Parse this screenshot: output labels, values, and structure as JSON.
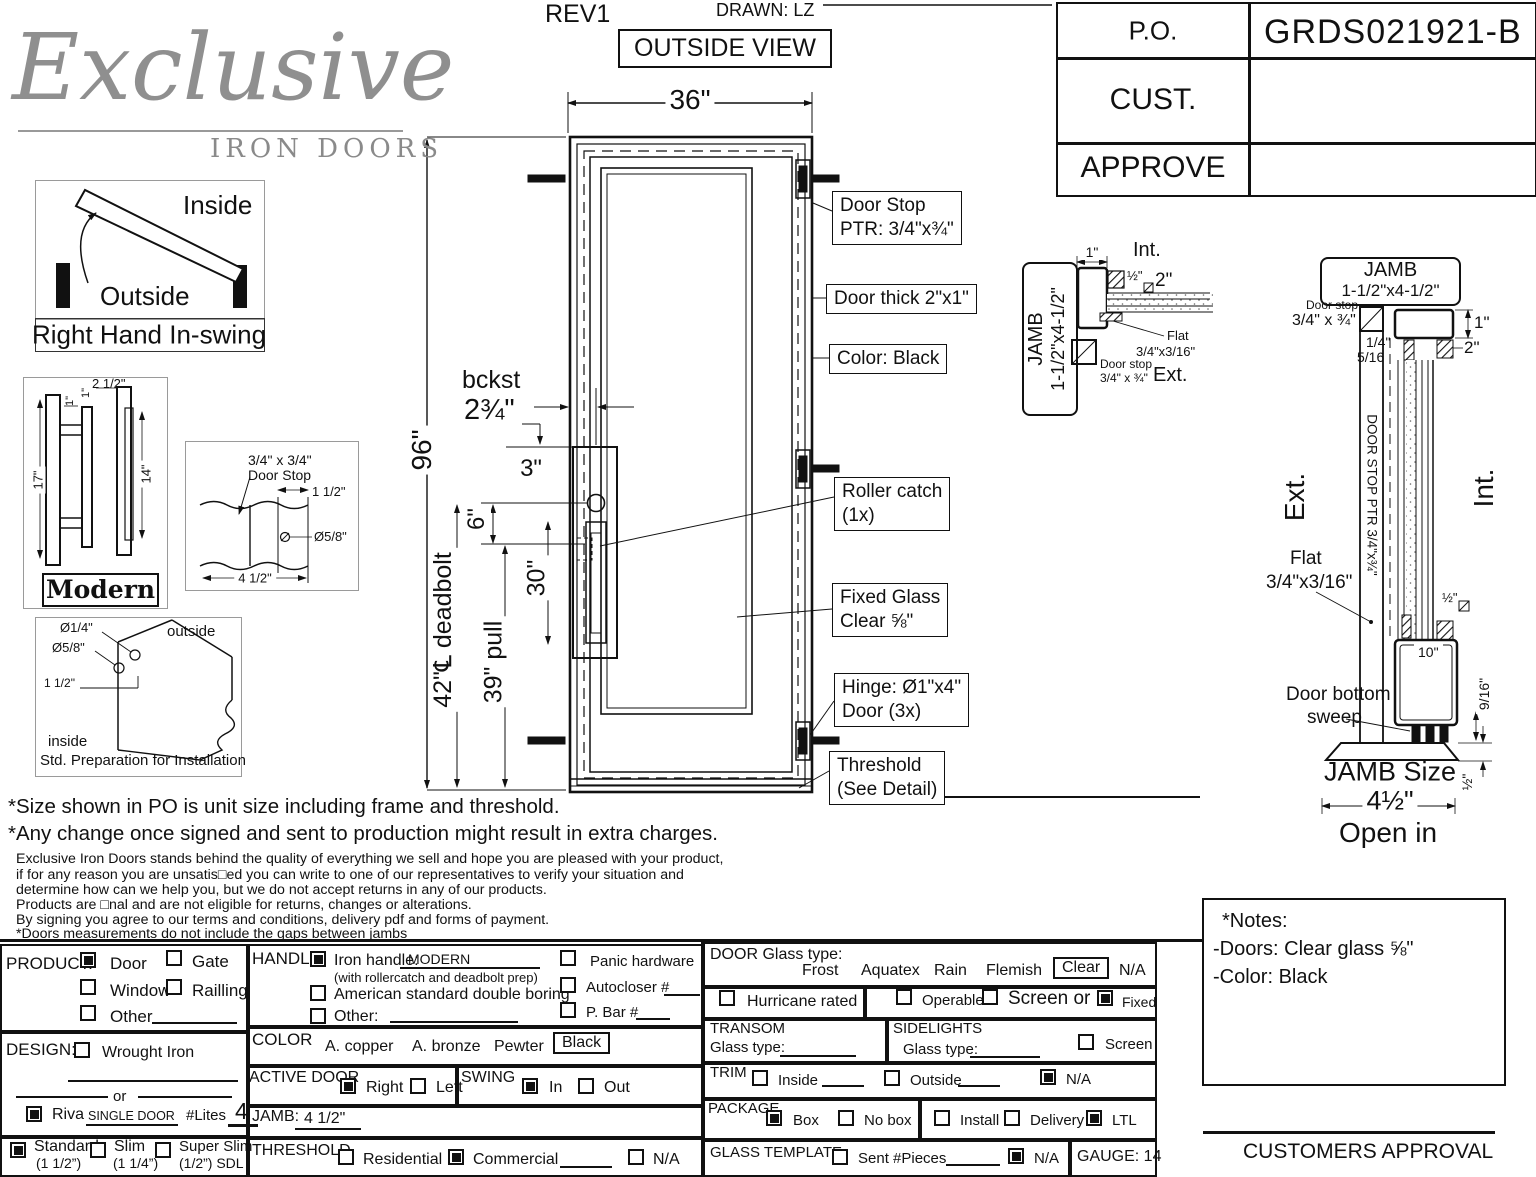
{
  "logo": {
    "script": "Exclusive",
    "sub": "IRON DOORS"
  },
  "header": {
    "rev": "REV1",
    "drawn": "DRAWN: LZ",
    "view": "OUTSIDE VIEW"
  },
  "po_table": {
    "po_label": "P.O.",
    "po_value": "GRDS021921-B",
    "cust_label": "CUST.",
    "approve_label": "APPROVE"
  },
  "swing_diagram": {
    "inside": "Inside",
    "outside": "Outside",
    "caption": "Right Hand In-swing"
  },
  "modern": {
    "caption": "Modern",
    "d17": "17\"",
    "d1a": "1\"",
    "d1b": "1\"",
    "d25": "2 1/2\"",
    "d14": "14\""
  },
  "doorstop_detail": {
    "l1": "3/4\" x 3/4\"",
    "l2": "Door Stop",
    "d1": "1 1/2\"",
    "d2": "Ø5/8\"",
    "d3": "4 1/2\""
  },
  "prep": {
    "d1": "Ø1/4\"",
    "d2": "Ø5/8\"",
    "d3": "1 1/2\"",
    "outside": "outside",
    "inside": "inside",
    "caption": "Std. Preparation for Installation"
  },
  "door": {
    "w": "36\"",
    "h": "96\"",
    "bckst1": "bckst",
    "bckst2": "2¾\"",
    "d3": "3\"",
    "d6": "6\"",
    "d30": "30\"",
    "d42": "42\"℄ deadbolt",
    "d39": "39\" pull"
  },
  "callouts": {
    "stop1": "Door Stop",
    "stop2": "PTR: 3/4\"x¾\"",
    "thick": "Door thick 2\"x1\"",
    "color": "Color: Black",
    "roller1": "Roller catch",
    "roller2": "(1x)",
    "glass1": "Fixed Glass",
    "glass2": "Clear ⅝\"",
    "hinge1": "Hinge: Ø1\"x4\"",
    "hinge2": "Door (3x)",
    "thresh1": "Threshold",
    "thresh2": "(See Detail)"
  },
  "jamb_mid": {
    "l1": "JAMB",
    "l2": "1-1/2\"x4-1/2\"",
    "int": "Int.",
    "ext": "Ext.",
    "d1": "1\"",
    "dhalf": "½\"",
    "d2": "2\"",
    "flat1": "Flat",
    "flat2": "3/4\"x3/16\"",
    "stop1": "Door stop",
    "stop2": "3/4\" x ¾\""
  },
  "jamb_right": {
    "l1": "JAMB",
    "l2": "1-1/2\"x4-1/2\"",
    "stop1": "Door stop",
    "stop2": "3/4\" x ¾\"",
    "d1": "1\"",
    "d2": "2\"",
    "d114": "1/4\"",
    "d516": "5/16",
    "ext": "Ext.",
    "int": "Int.",
    "vert": "DOOR STOP PTR 3/4\"x¾\"",
    "flat1": "Flat",
    "flat2": "3/4\"x3/16\"",
    "dhalf": "½\"",
    "d10": "10\"",
    "sweep1": "Door bottom",
    "sweep2": "sweep",
    "d916": "9/16\"",
    "size": "JAMB Size",
    "d412": "4½\"",
    "dhalf2": "½\"",
    "open": "Open in"
  },
  "disclaimer": {
    "b1": "*Size shown in PO is unit size including frame and threshold.",
    "b2": "*Any change once signed and sent to production might result in extra charges.",
    "s1": "Exclusive Iron Doors stands behind the quality of everything we sell and hope you are pleased with your product,",
    "s2": "if for any reason you are unsatis□ed you can write to one of our representatives to verify your situation and",
    "s3": "determine how can we help you, but we do not accept returns in any of our products.",
    "s4": "Products are □nal and are not eligible for returns, changes or alterations.",
    "s5": "By signing you agree to our terms and conditions, delivery pdf and forms of payment.",
    "s6": "*Doors measurements do not include the gaps between jambs"
  },
  "notes": {
    "title": "*Notes:",
    "l1": "-Doors: Clear glass ⅝\"",
    "l2": "-Color: Black"
  },
  "form": {
    "product": {
      "label": "PRODUCT:",
      "door": {
        "label": "Door",
        "checked": true
      },
      "gate": {
        "label": "Gate",
        "checked": false
      },
      "window": {
        "label": "Window",
        "checked": false
      },
      "railling": {
        "label": "Railling",
        "checked": false
      },
      "other": {
        "label": "Other",
        "checked": false
      }
    },
    "design": {
      "label": "DESIGN:",
      "wrought": {
        "label": "Wrought Iron",
        "checked": false
      },
      "or": "or"
    },
    "riva": {
      "checked": true,
      "label": "Riva",
      "value": "SINGLE DOOR",
      "lites_label": "#Lites",
      "lites_value": "4"
    },
    "thickness": {
      "std": {
        "label": "Standard",
        "sub": "(1 1/2”)",
        "checked": true
      },
      "slim": {
        "label": "Slim",
        "sub": "(1 1/4”)",
        "checked": false
      },
      "super": {
        "label": "Super Slim",
        "sub": "(1/2”) SDL",
        "checked": false
      }
    },
    "handle": {
      "label": "HANDLE",
      "iron": {
        "label": "Iron handle:",
        "value": "MODERN",
        "sub": "(with rollercatch and deadbolt prep)",
        "checked": true
      },
      "american": {
        "label": "American standard double boring",
        "checked": false
      },
      "other": {
        "label": "Other:",
        "checked": false
      },
      "panic": {
        "label": "Panic hardware",
        "checked": false
      },
      "autocloser": {
        "label": "Autocloser #",
        "checked": false
      },
      "pbar": {
        "label": "P. Bar #",
        "checked": false
      }
    },
    "color": {
      "label": "COLOR",
      "o1": "A. copper",
      "o2": "A. bronze",
      "o3": "Pewter",
      "selected": "Black"
    },
    "active": {
      "label": "ACTIVE DOOR",
      "right": {
        "label": "Right",
        "checked": true
      },
      "left": {
        "label": "Left",
        "checked": false
      }
    },
    "swing": {
      "label": "SWING",
      "in": {
        "label": "In",
        "checked": true
      },
      "out": {
        "label": "Out",
        "checked": false
      }
    },
    "jamb": {
      "label": "JAMB:",
      "value": "4 1/2\""
    },
    "threshold": {
      "label": "THRESHOLD",
      "res": {
        "label": "Residential",
        "checked": false
      },
      "com": {
        "label": "Commercial",
        "checked": true
      },
      "na": {
        "label": "N/A",
        "checked": false
      }
    },
    "glass": {
      "label": "DOOR Glass type:",
      "o1": "Frost",
      "o2": "Aquatex",
      "o3": "Rain",
      "o4": "Flemish",
      "selected": "Clear",
      "o6": "N/A"
    },
    "hurricane": {
      "label": "Hurricane rated",
      "checked": false
    },
    "operable": {
      "label": "Operable",
      "checked": false
    },
    "screen_or": {
      "label": "Screen or",
      "checked": false
    },
    "fixed": {
      "label": "Fixed",
      "checked": true
    },
    "transom": {
      "label": "TRANSOM",
      "glass": "Glass type:"
    },
    "sidelights": {
      "label": "SIDELIGHTS",
      "glass": "Glass type:",
      "screen": {
        "label": "Screen",
        "checked": false
      }
    },
    "trim": {
      "label": "TRIM",
      "inside": {
        "label": "Inside",
        "checked": false
      },
      "outside": {
        "label": "Outside",
        "checked": false
      },
      "na": {
        "label": "N/A",
        "checked": true
      }
    },
    "package": {
      "label": "PACKAGE",
      "box": {
        "label": "Box",
        "checked": true
      },
      "nobox": {
        "label": "No box",
        "checked": false
      },
      "install": {
        "label": "Install",
        "checked": false
      },
      "delivery": {
        "label": "Delivery",
        "checked": false
      },
      "ltl": {
        "label": "LTL",
        "checked": true
      }
    },
    "template": {
      "label": "GLASS TEMPLATE",
      "sent": {
        "label": "Sent #Pieces",
        "checked": false
      },
      "na": {
        "label": "N/A",
        "checked": true
      }
    },
    "gauge": "GAUGE: 14"
  },
  "approval": "CUSTOMERS APPROVAL"
}
